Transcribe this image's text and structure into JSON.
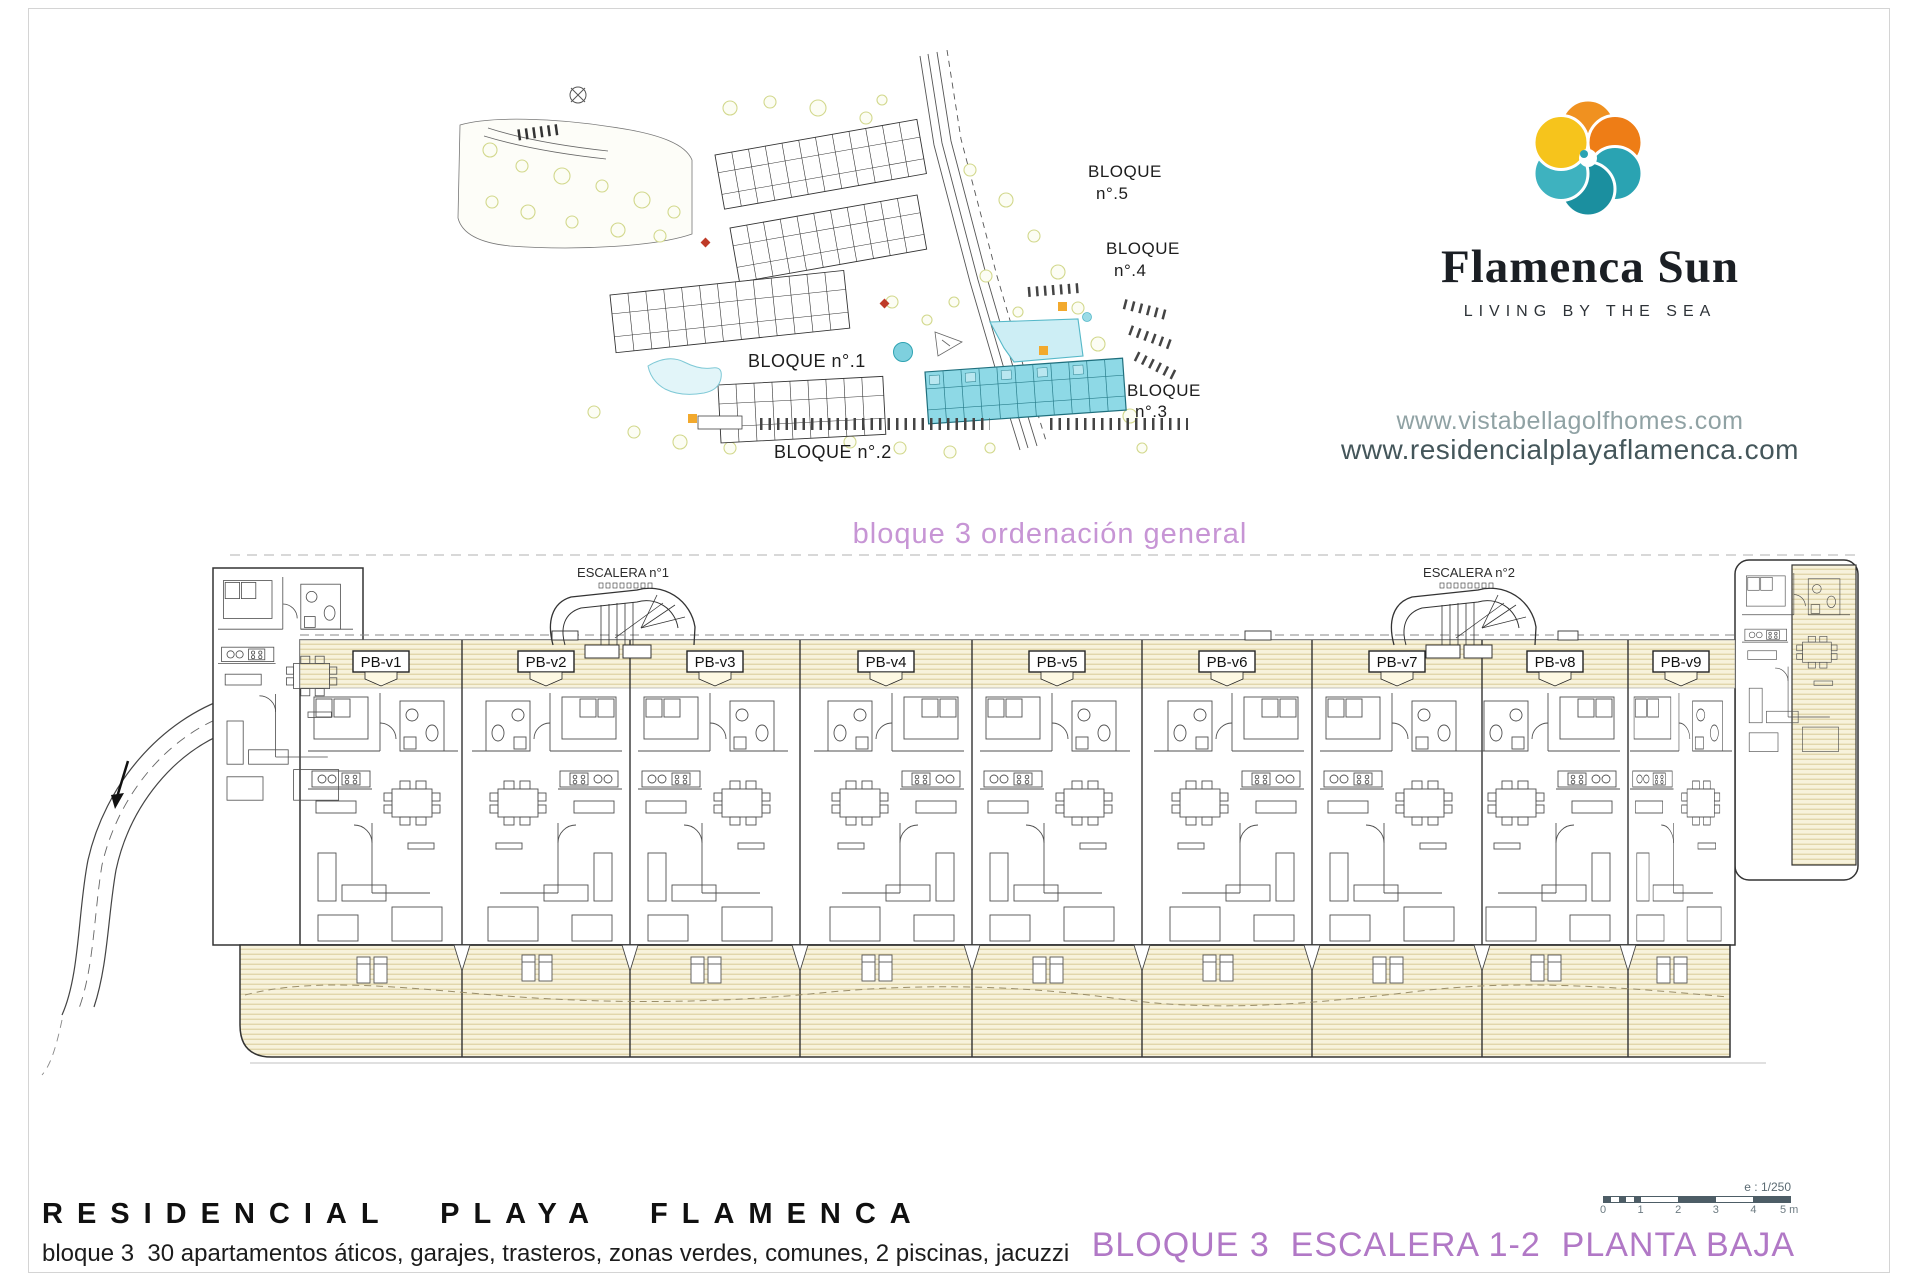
{
  "brand": {
    "name": "Flamenca Sun",
    "tagline": "LIVING BY THE SEA"
  },
  "websites": {
    "url1": "www.vistabellagolfhomes.com",
    "url2": "www.residencialplayaflamenca.com"
  },
  "siteplan": {
    "caption": "bloque 3 ordenación general",
    "blocks": {
      "b5": {
        "line1": "BLOQUE",
        "line2": "n°.5"
      },
      "b4": {
        "line1": "BLOQUE",
        "line2": "n°.4"
      },
      "b3": {
        "line1": "BLOQUE",
        "line2": "n°.3"
      },
      "b1": {
        "label": "BLOQUE n°.1"
      },
      "b2": {
        "label": "BLOQUE n°.2"
      }
    }
  },
  "floorplan": {
    "stairs": [
      {
        "label": "ESCALERA n°1"
      },
      {
        "label": "ESCALERA n°2"
      }
    ],
    "units": [
      {
        "label": "PB-v1"
      },
      {
        "label": "PB-v2"
      },
      {
        "label": "PB-v3"
      },
      {
        "label": "PB-v4"
      },
      {
        "label": "PB-v5"
      },
      {
        "label": "PB-v6"
      },
      {
        "label": "PB-v7"
      },
      {
        "label": "PB-v8"
      },
      {
        "label": "PB-v9"
      }
    ]
  },
  "footer": {
    "title": "RESIDENCIAL PLAYA FLAMENCA",
    "subtitle": "bloque 3  30 apartamentos áticos, garajes, trasteros, zonas verdes, comunes, 2 piscinas, jacuzzi"
  },
  "sheet": {
    "title": "BLOQUE 3  ESCALERA 1-2  PLANTA BAJA",
    "scale_label": "e : 1/250",
    "scale_ticks": [
      "0",
      "1",
      "2",
      "3",
      "4",
      "5 m"
    ]
  },
  "colors": {
    "accent_purple": "#b178c6",
    "caption_purple": "#c795d5",
    "logo_orange": "#f09120",
    "logo_deep_orange": "#ee7d16",
    "logo_teal": "#2aa3b2",
    "logo_dark_teal": "#1b8f9f",
    "logo_yellow": "#f6c41c",
    "highlight_cyan": "#8ed9e6",
    "pool_cyan": "#cdeef5",
    "url_light": "#90a2a4",
    "url_dark": "#44565a",
    "scalebar_dark": "#4d5d66",
    "hatch_tan": "#d8ca96"
  }
}
